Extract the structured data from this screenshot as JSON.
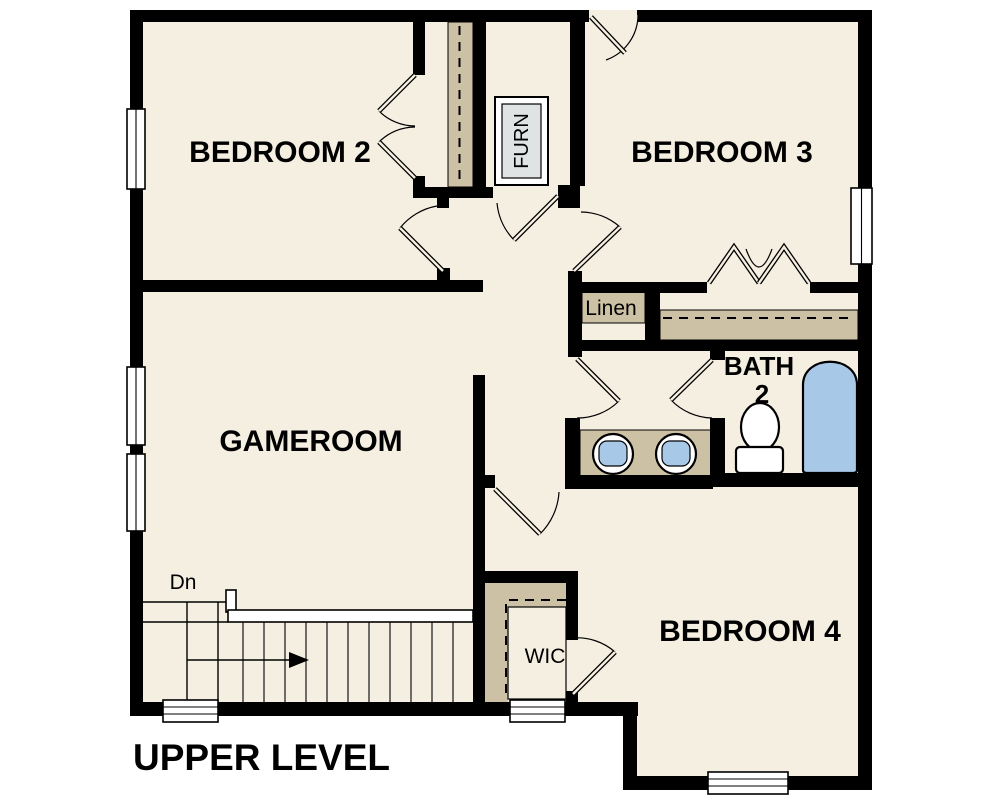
{
  "title": "UPPER LEVEL",
  "rooms": {
    "bedroom2": "BEDROOM 2",
    "bedroom3": "BEDROOM 3",
    "gameroom": "GAMEROOM",
    "bedroom4": "BEDROOM 4",
    "bath_line1": "BATH",
    "bath_line2": "2",
    "linen": "Linen",
    "wic": "WIC",
    "furn": "FURN"
  },
  "stairs": {
    "direction_label": "Dn"
  },
  "colors": {
    "background": "#FFFFFF",
    "floor": "#F5EFE2",
    "wall": "#000000",
    "closet_tan": "#CDC1A5",
    "fixture_blue": "#A8C8E8",
    "furnace_gray": "#E0E3E3"
  }
}
